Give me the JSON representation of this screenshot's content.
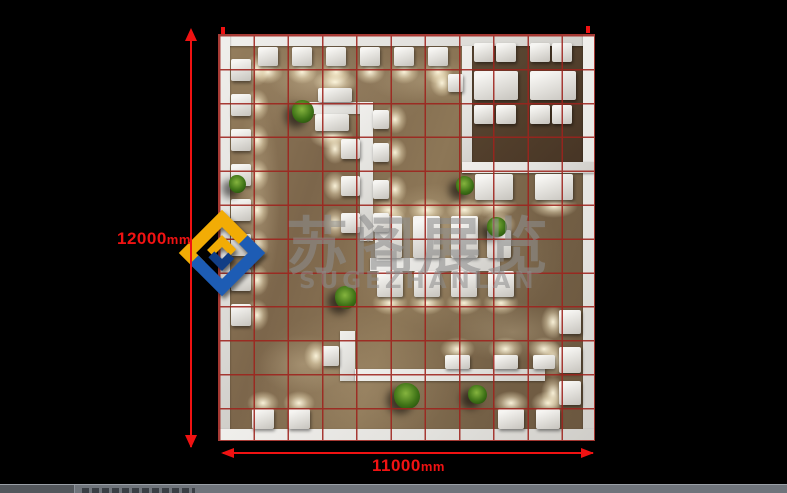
{
  "colors": {
    "bg": "#000000",
    "dim-red": "#f01212",
    "grid-red": "#9e231d",
    "wall": "#e9e8e5",
    "floor-mid": "#8a7355",
    "room-floor": "#57432f",
    "wm-gray": "#8d8d8d",
    "logo-blue": "#1d5cb4",
    "logo-blue-dark": "#123e85",
    "logo-yellow": "#f2ac05",
    "taskbar": "#6f747b",
    "taskbar-dark": "#53575c",
    "taskbar-text": "#3a3e44"
  },
  "dims": {
    "vertical": {
      "value": "12000",
      "unit": "mm"
    },
    "horizontal": {
      "value": "11000",
      "unit": "mm"
    }
  },
  "watermark": {
    "cjk": "苏阁展览",
    "latin": "SUGEZHANLAN"
  },
  "taskbar": {
    "clipped_text": ""
  },
  "plan": {
    "left": 218,
    "top": 34,
    "width": 377,
    "height": 407,
    "grid": {
      "cols": 11,
      "rows": 12,
      "cell_mm": 1000
    },
    "layers": [
      {
        "kind": "pool",
        "rects": [
          [
            50,
            20,
            90,
            50
          ],
          [
            150,
            22,
            120,
            48
          ],
          [
            18,
            60,
            44,
            210
          ],
          [
            150,
            150,
            130,
            80
          ],
          [
            230,
            268,
            130,
            60
          ],
          [
            40,
            300,
            90,
            60
          ],
          [
            295,
            55,
            60,
            70
          ]
        ]
      },
      {
        "kind": "room-floor",
        "rects": [
          [
            254,
            12,
            111,
            116
          ]
        ]
      },
      {
        "kind": "wall",
        "name": "perimeter-wall",
        "rects": [
          [
            0,
            0,
            377,
            12
          ],
          [
            0,
            0,
            12,
            407
          ],
          [
            365,
            0,
            12,
            407
          ],
          [
            0,
            395,
            377,
            12
          ],
          [
            244,
            12,
            10,
            127
          ],
          [
            244,
            128,
            133,
            11
          ]
        ]
      },
      {
        "kind": "wall",
        "name": "partition-wall",
        "rects": [
          [
            82,
            68,
            73,
            12
          ],
          [
            142,
            68,
            13,
            139
          ],
          [
            152,
            224,
            130,
            13
          ],
          [
            122,
            297,
            15,
            50
          ],
          [
            137,
            335,
            190,
            12
          ]
        ]
      },
      {
        "kind": "block",
        "glow": "down",
        "rects": [
          [
            40,
            13,
            20,
            19
          ],
          [
            74,
            13,
            20,
            19
          ],
          [
            108,
            13,
            20,
            19
          ],
          [
            142,
            13,
            20,
            19
          ],
          [
            176,
            13,
            20,
            19
          ],
          [
            210,
            13,
            20,
            19
          ]
        ]
      },
      {
        "kind": "block",
        "glow": "right",
        "rects": [
          [
            13,
            25,
            20,
            22
          ],
          [
            13,
            60,
            20,
            22
          ],
          [
            13,
            95,
            20,
            22
          ],
          [
            13,
            130,
            20,
            22
          ],
          [
            13,
            165,
            20,
            22
          ],
          [
            13,
            200,
            20,
            22
          ],
          [
            13,
            235,
            20,
            22
          ],
          [
            13,
            270,
            20,
            22
          ]
        ]
      },
      {
        "kind": "block",
        "glow": "up",
        "rects": [
          [
            34,
            375,
            22,
            20
          ],
          [
            70,
            375,
            22,
            20
          ],
          [
            280,
            375,
            26,
            20
          ],
          [
            318,
            375,
            24,
            20
          ]
        ]
      },
      {
        "kind": "block",
        "glow": "left",
        "rects": [
          [
            341,
            276,
            22,
            24
          ],
          [
            341,
            313,
            22,
            26
          ],
          [
            341,
            347,
            22,
            24
          ],
          [
            104,
            312,
            17,
            20
          ],
          [
            230,
            40,
            15,
            18
          ]
        ]
      },
      {
        "kind": "block",
        "glow": "down",
        "rects": [
          [
            257,
            140,
            38,
            26
          ],
          [
            317,
            140,
            38,
            26
          ]
        ]
      },
      {
        "kind": "block",
        "glow": "up",
        "rects": [
          [
            100,
            54,
            34,
            14
          ],
          [
            157,
            182,
            27,
            42
          ],
          [
            195,
            182,
            27,
            42
          ],
          [
            233,
            182,
            27,
            42
          ],
          [
            269,
            196,
            24,
            28
          ],
          [
            227,
            321,
            25,
            14
          ],
          [
            275,
            321,
            25,
            14
          ],
          [
            315,
            321,
            22,
            14
          ]
        ]
      },
      {
        "kind": "block",
        "glow": "down",
        "rects": [
          [
            97,
            80,
            34,
            17
          ],
          [
            159,
            237,
            26,
            26
          ],
          [
            196,
            237,
            26,
            26
          ],
          [
            233,
            237,
            26,
            26
          ],
          [
            270,
            237,
            26,
            26
          ]
        ]
      },
      {
        "kind": "block",
        "glow": "left",
        "rects": [
          [
            123,
            105,
            19,
            20
          ],
          [
            123,
            142,
            19,
            20
          ],
          [
            123,
            179,
            19,
            20
          ]
        ]
      },
      {
        "kind": "block",
        "glow": "right",
        "rects": [
          [
            155,
            76,
            16,
            19
          ],
          [
            155,
            109,
            16,
            19
          ],
          [
            155,
            146,
            16,
            19
          ],
          [
            155,
            179,
            16,
            19
          ]
        ]
      },
      {
        "kind": "block",
        "glow": "none",
        "name": "meeting-table",
        "rects": [
          [
            256,
            9,
            20,
            19
          ],
          [
            278,
            9,
            20,
            19
          ],
          [
            312,
            9,
            20,
            19
          ],
          [
            334,
            9,
            20,
            19
          ],
          [
            256,
            37,
            44,
            29
          ],
          [
            312,
            37,
            46,
            29
          ],
          [
            256,
            71,
            20,
            19
          ],
          [
            278,
            71,
            20,
            19
          ],
          [
            312,
            71,
            20,
            19
          ],
          [
            334,
            71,
            20,
            19
          ]
        ]
      },
      {
        "kind": "plant",
        "rects": [
          [
            74,
            66,
            22,
            23
          ],
          [
            11,
            141,
            17,
            18
          ],
          [
            117,
            252,
            22,
            23
          ],
          [
            269,
            183,
            20,
            20
          ],
          [
            238,
            142,
            18,
            19
          ],
          [
            176,
            349,
            26,
            26
          ],
          [
            250,
            351,
            19,
            19
          ]
        ]
      }
    ]
  }
}
